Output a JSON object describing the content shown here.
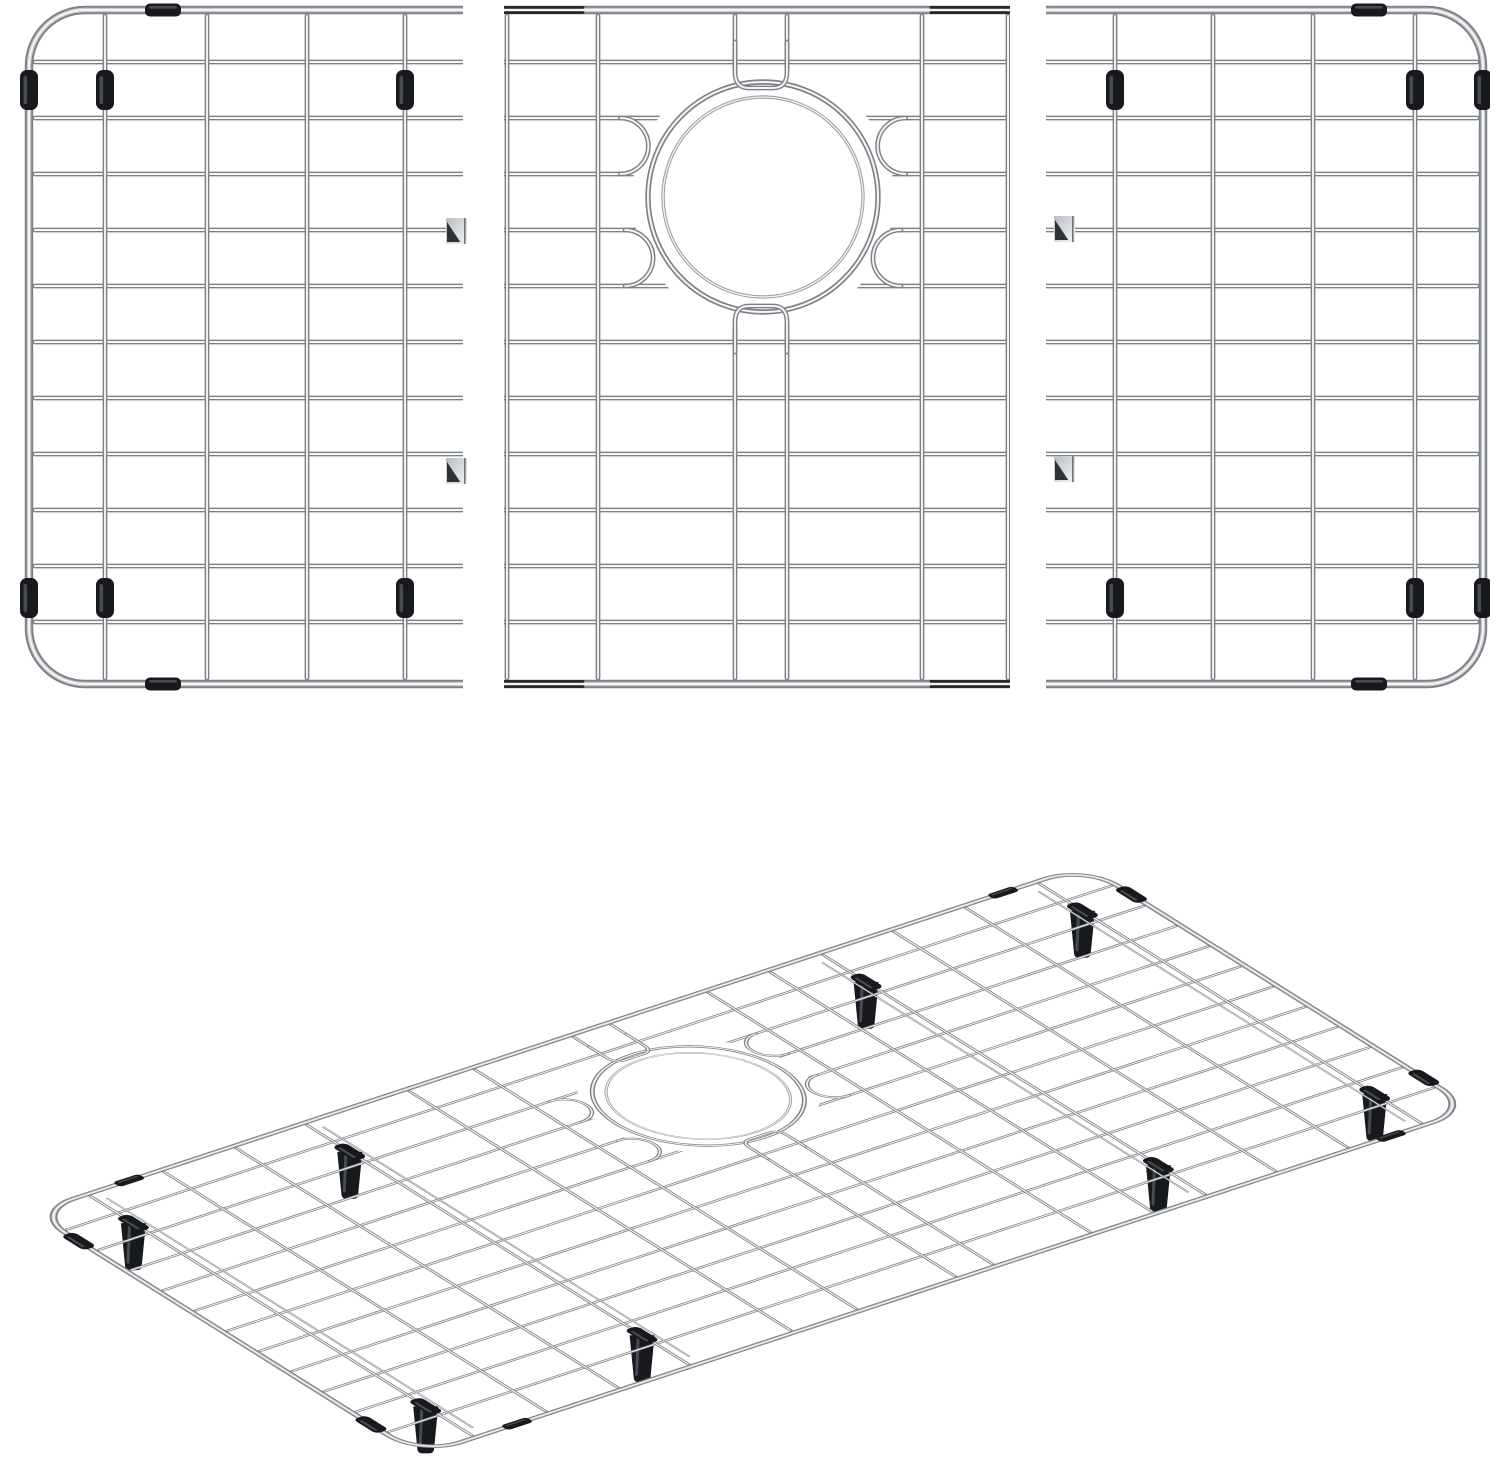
{
  "scene": {
    "width": 1500,
    "height": 1483,
    "background": "#ffffff",
    "alt": "Stainless steel kitchen sink bottom grid protector: three flat top-view sections (left, center with round drain opening, right) and one assembled grid shown in perspective below"
  },
  "colors": {
    "wire_edge": "#7e8287",
    "wire_mid": "#c7cacd",
    "wire_core": "#f4f5f6",
    "ring_inner_edge": "#9ba0a5",
    "rubber": "#17191c",
    "rubber_hi": "#474b52",
    "stub": "#26282b",
    "sep_face": "#e9ebee",
    "sep_dark": "#303336",
    "white": "#ffffff"
  },
  "grid": {
    "frame": {
      "x0": 2,
      "y0": 2,
      "x1": 1462,
      "y1": 676,
      "r": 56
    },
    "rows": [
      54,
      110,
      166,
      222,
      278,
      334,
      390,
      446,
      502,
      558,
      614
    ],
    "cols": [
      78,
      180,
      280,
      378,
      520,
      611,
      748,
      800,
      935,
      1021,
      1094,
      1192,
      1292,
      1394
    ],
    "support_cols": [
      90,
      390,
      1082,
      1382
    ],
    "drain": {
      "cx": 776,
      "cy": 189,
      "r_outer": 115,
      "r_inner": 100,
      "mask_r": 131
    },
    "slot": {
      "x1": 748,
      "x2": 800,
      "rx": 14
    },
    "tab_pairs": [
      [
        110,
        166
      ],
      [
        222,
        278
      ]
    ],
    "feet_cols": [
      78,
      378,
      1094,
      1394
    ],
    "feet_rows": [
      82,
      590
    ],
    "bumper_xs": [
      118,
      1330
    ],
    "bumper": {
      "w": 36,
      "h": 13
    },
    "clip_rows": [
      82,
      590
    ]
  },
  "sections": [
    {
      "name": "left-section",
      "dx": 27,
      "dy": 8,
      "clip": [
        16,
        0,
        447,
        716
      ],
      "stubs": []
    },
    {
      "name": "center-section",
      "dx": -13,
      "dy": 8,
      "clip": [
        504,
        0,
        506,
        716
      ],
      "stubs": [
        [
          505,
          583,
          10
        ],
        [
          931,
          1009,
          10
        ],
        [
          505,
          583,
          684
        ],
        [
          931,
          1009,
          684
        ]
      ]
    },
    {
      "name": "right-section",
      "dx": 21,
      "dy": 8,
      "clip": [
        1046,
        0,
        444,
        716
      ],
      "stubs": []
    }
  ],
  "separators": [
    [
      446,
      218
    ],
    [
      446,
      458
    ],
    [
      1054,
      216
    ],
    [
      1054,
      456
    ]
  ],
  "separator_size": [
    21,
    26
  ],
  "perspective": {
    "matrix": [
      0.7211,
      -0.2374,
      0.5754,
      0.3609,
      30,
      1212
    ],
    "peg": {
      "top_w": 25,
      "bot_w": 17,
      "h": 47
    }
  }
}
